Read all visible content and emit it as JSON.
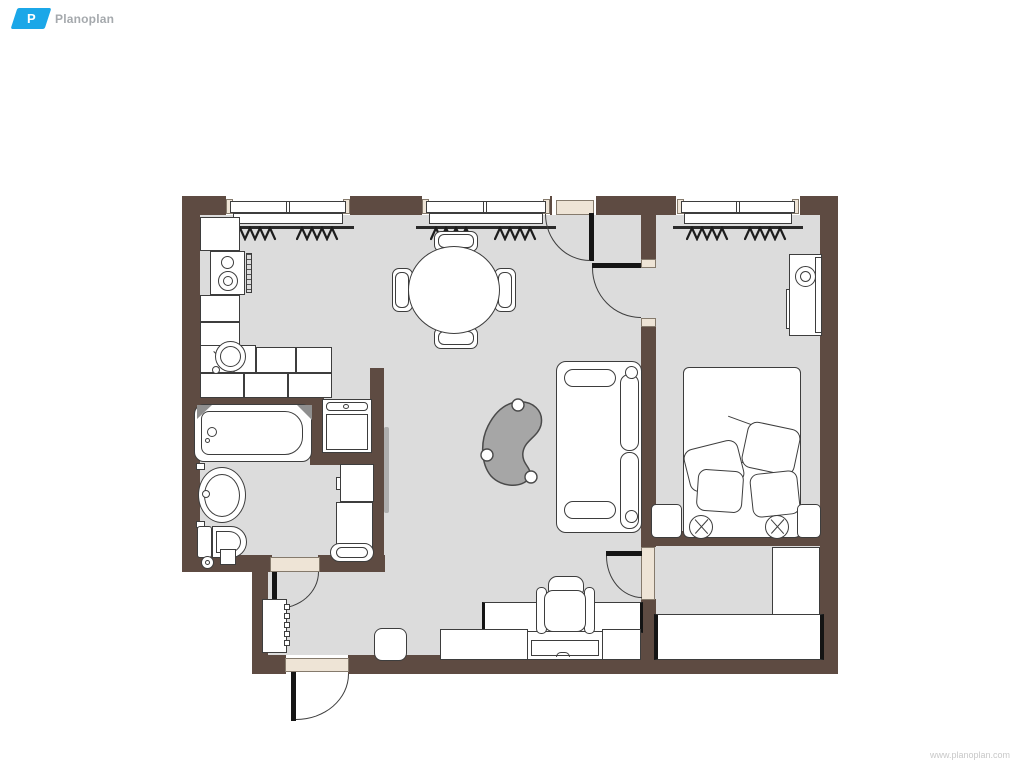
{
  "logo": {
    "initial": "P",
    "name": "Planoplan"
  },
  "footer": {
    "watermark": "www.planoplan.com"
  },
  "theme": {
    "wall": "#5e4b42",
    "floor": "#dcdcdc",
    "line": "#3d3d3d",
    "furniture_fill": "#ffffff",
    "trim": "#eee4d6",
    "table_fill": "#a6a6a6",
    "door_leaf": "#151515",
    "brand_blue": "#1ba7e8",
    "logo_text": "#a5a9ad",
    "watermark_text": "#c8c8c8"
  }
}
